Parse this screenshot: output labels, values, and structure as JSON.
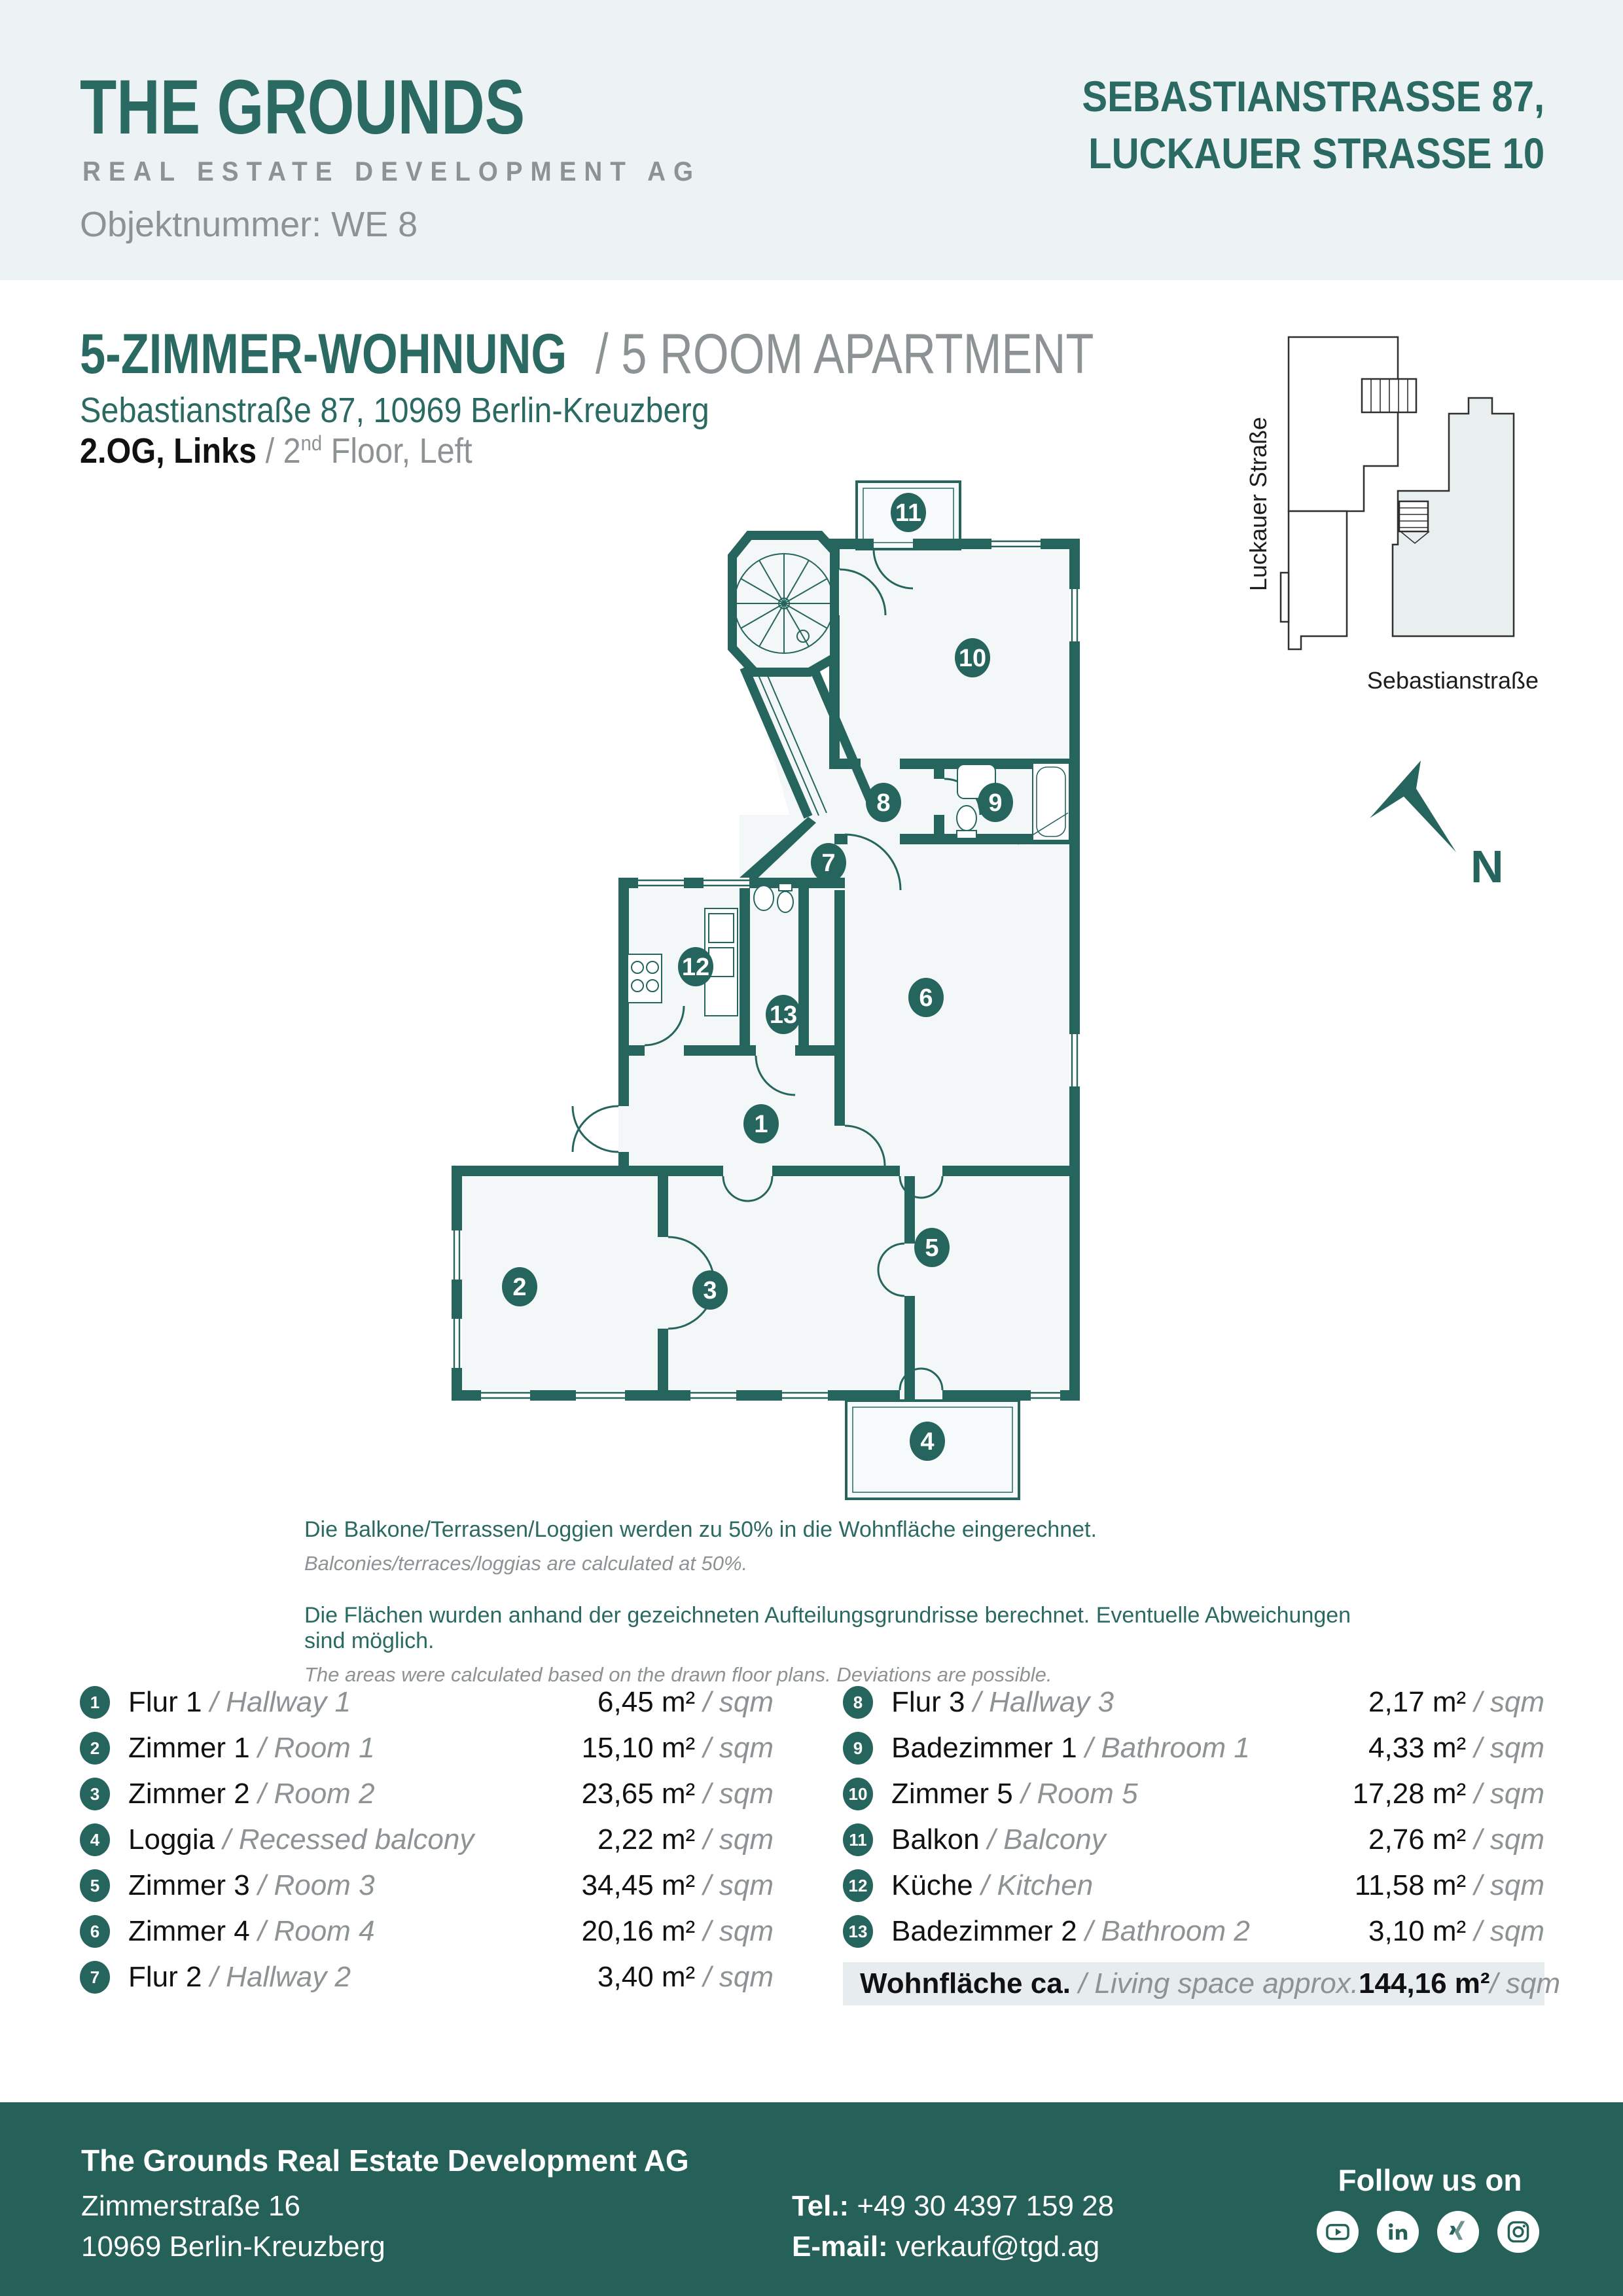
{
  "header": {
    "logo_title": "THE GROUNDS",
    "logo_subtitle": "REAL ESTATE DEVELOPMENT AG",
    "object_number": "Objektnummer: WE 8",
    "address_title_line1": "SEBASTIANSTRASSE 87,",
    "address_title_line2": "LUCKAUER STRASSE 10"
  },
  "title_block": {
    "title_de": "5-ZIMMER-WOHNUNG",
    "title_sep": " / ",
    "title_en": "5 ROOM APARTMENT",
    "address": "Sebastianstraße 87, 10969 Berlin-Kreuzberg",
    "floor_de": "2.OG, Links",
    "floor_sep": " / ",
    "floor_en_pre": "2",
    "floor_en_sup": "nd",
    "floor_en_post": " Floor, Left"
  },
  "site_map": {
    "street_left": "Luckauer Straße",
    "street_bottom": "Sebastianstraße"
  },
  "compass": {
    "label": "N"
  },
  "floor_plan": {
    "badges": [
      "1",
      "2",
      "3",
      "4",
      "5",
      "6",
      "7",
      "8",
      "9",
      "10",
      "11",
      "12",
      "13"
    ]
  },
  "notes": [
    {
      "de": "Die Balkone/Terrassen/Loggien werden  zu 50% in die Wohnfläche eingerechnet.",
      "en": "Balconies/terraces/loggias are calculated at 50%."
    },
    {
      "de": "Die Flächen wurden anhand der gezeichneten Aufteilungsgrundrisse berechnet. Eventuelle Abweichungen sind möglich.",
      "en": "The areas were calculated based on the drawn floor plans. Deviations are possible."
    }
  ],
  "units": {
    "m2": " m²",
    "per_sqm": " / sqm",
    "name_sep": " / "
  },
  "rooms": {
    "left": [
      {
        "num": "1",
        "de": "Flur 1",
        "en": "Hallway 1",
        "area": "6,45"
      },
      {
        "num": "2",
        "de": "Zimmer 1",
        "en": "Room 1",
        "area": "15,10"
      },
      {
        "num": "3",
        "de": "Zimmer 2",
        "en": "Room 2",
        "area": "23,65"
      },
      {
        "num": "4",
        "de": "Loggia",
        "en": "Recessed balcony",
        "area": "2,22"
      },
      {
        "num": "5",
        "de": "Zimmer 3",
        "en": "Room 3",
        "area": "34,45"
      },
      {
        "num": "6",
        "de": "Zimmer 4",
        "en": "Room 4",
        "area": "20,16"
      },
      {
        "num": "7",
        "de": "Flur 2",
        "en": "Hallway 2",
        "area": "3,40"
      }
    ],
    "right": [
      {
        "num": "8",
        "de": "Flur 3",
        "en": "Hallway 3",
        "area": "2,17"
      },
      {
        "num": "9",
        "de": "Badezimmer 1",
        "en": "Bathroom 1",
        "area": "4,33"
      },
      {
        "num": "10",
        "de": "Zimmer 5",
        "en": "Room 5",
        "area": "17,28"
      },
      {
        "num": "11",
        "de": "Balkon",
        "en": "Balcony",
        "area": "2,76"
      },
      {
        "num": "12",
        "de": "Küche",
        "en": "Kitchen",
        "area": "11,58"
      },
      {
        "num": "13",
        "de": "Badezimmer 2",
        "en": "Bathroom 2",
        "area": "3,10"
      }
    ],
    "total": {
      "de": "Wohnfläche ca.",
      "en": "/ Living space approx.",
      "area": "144,16"
    }
  },
  "footer": {
    "company": "The Grounds Real Estate Development AG",
    "street": "Zimmerstraße 16",
    "city": "10969 Berlin-Kreuzberg",
    "tel_label": "Tel.:",
    "tel_value": " +49 30 4397 159 28",
    "email_label": "E-mail:",
    "email_value": " verkauf@tgd.ag",
    "follow": "Follow us on",
    "social": [
      "youtube",
      "linkedin",
      "xing",
      "instagram"
    ]
  },
  "colors": {
    "brand_teal": "#2a6a62",
    "wall_teal": "#26655d",
    "footer_teal": "#256159",
    "header_band": "#edf2f4",
    "room_fill": "#f3f7f7",
    "gray_text": "#8d9294",
    "total_row_bg": "#e7edee",
    "map_highlight": "#e9efee"
  }
}
